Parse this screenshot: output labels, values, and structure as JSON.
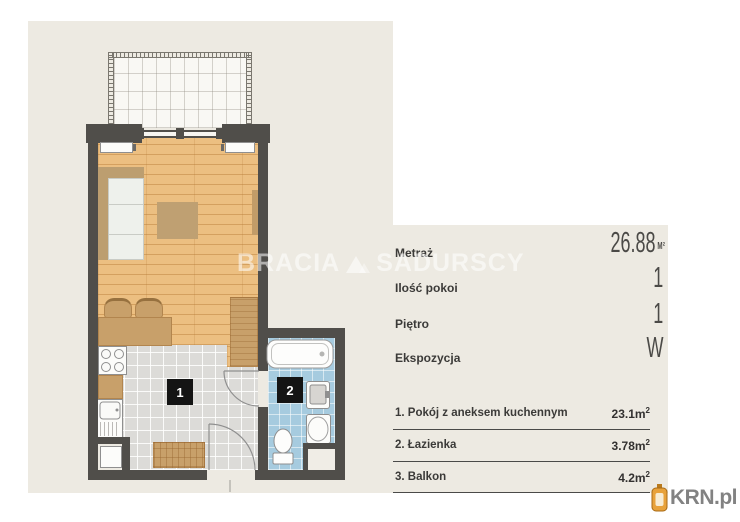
{
  "watermark": {
    "left": "BRACIA",
    "right": "SADURSCY"
  },
  "logo": {
    "label": "KRN.pl"
  },
  "plan": {
    "room1_label": "1",
    "room2_label": "2"
  },
  "details": {
    "rows": [
      {
        "label": "Metraż",
        "value": "26.88",
        "unit": "M²"
      },
      {
        "label": "Ilość pokoi",
        "value": "1",
        "unit": ""
      },
      {
        "label": "Piętro",
        "value": "1",
        "unit": ""
      },
      {
        "label": "Ekspozycja",
        "value": "W",
        "unit": ""
      }
    ]
  },
  "rooms": {
    "rows": [
      {
        "name": "1. Pokój z aneksem kuchennym",
        "area": "23.1m",
        "sup": "2"
      },
      {
        "name": "2. Łazienka",
        "area": "3.78m",
        "sup": "2"
      },
      {
        "name": "3. Balkon",
        "area": "4.2m",
        "sup": "2"
      }
    ]
  },
  "colors": {
    "background": "#EDEAE2",
    "wall": "#504E4A",
    "wood_floor": "#ECBF81",
    "tile_floor": "#DCDBD8",
    "bathroom_tile": "#A6CBDF",
    "accent_orange": "#E8A23B",
    "text_dark": "#3B3A38"
  }
}
